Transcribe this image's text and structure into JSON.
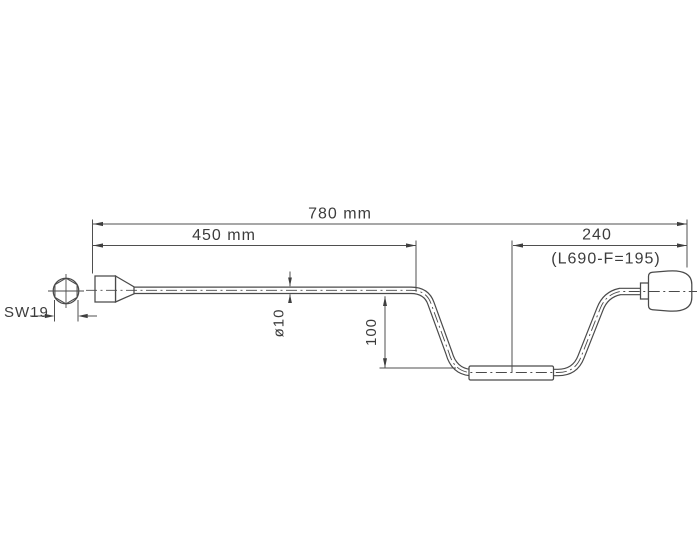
{
  "drawing": {
    "kind": "technical-drawing",
    "part": "crank-handle-with-hex-socket",
    "background_color": "#ffffff",
    "outline_color": "#4a4a4a",
    "dimension_line_color": "#4f4f4f",
    "text_color": "#3c3c3c",
    "dimensions": {
      "total_length": "780 mm",
      "upper_shaft_length": "450 mm",
      "crank_arm_length": "240",
      "crank_arm_note": "(L690-F=195)",
      "hex_width_across_flats": "SW19",
      "tube_diameter": "ø10",
      "crank_drop": "100"
    }
  }
}
